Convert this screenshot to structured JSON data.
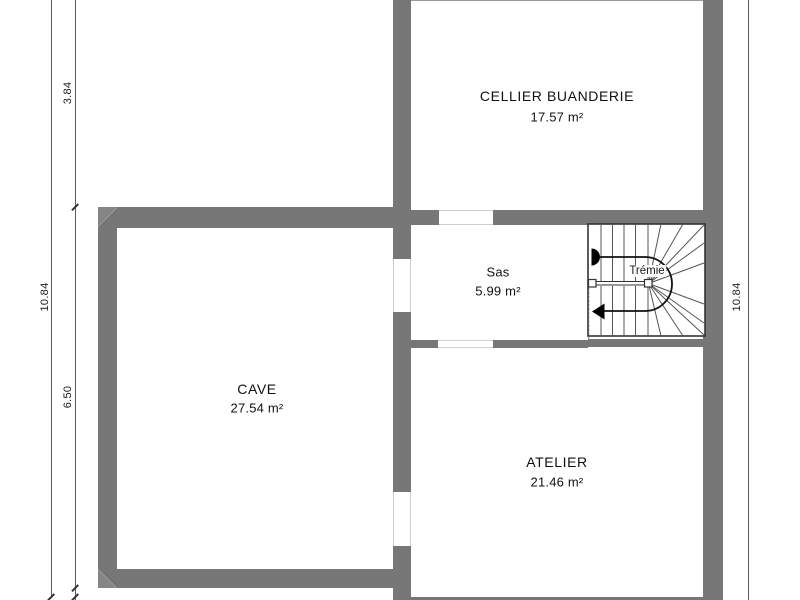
{
  "plan": {
    "title": "basement-floor-plan",
    "rooms": [
      {
        "id": "cellier",
        "name": "CELLIER BUANDERIE",
        "area": "17.57 m²"
      },
      {
        "id": "sas",
        "name": "Sas",
        "area": "5.99 m²"
      },
      {
        "id": "cave",
        "name": "CAVE",
        "area": "27.54 m²"
      },
      {
        "id": "atelier",
        "name": "ATELIER",
        "area": "21.46 m²"
      }
    ],
    "stair": {
      "label": "Trémie"
    },
    "dimensions": {
      "left_total": "10.84",
      "left_top_segment": "3.84",
      "left_bottom_segment": "6.50",
      "right_total": "10.84"
    },
    "colors": {
      "wall": "#777777",
      "dimension_line": "#5a5a5a",
      "stair_outline": "#333333",
      "stair_treads": "#555555",
      "walking_line": "#111111",
      "text": "#111111",
      "background": "#ffffff"
    }
  }
}
